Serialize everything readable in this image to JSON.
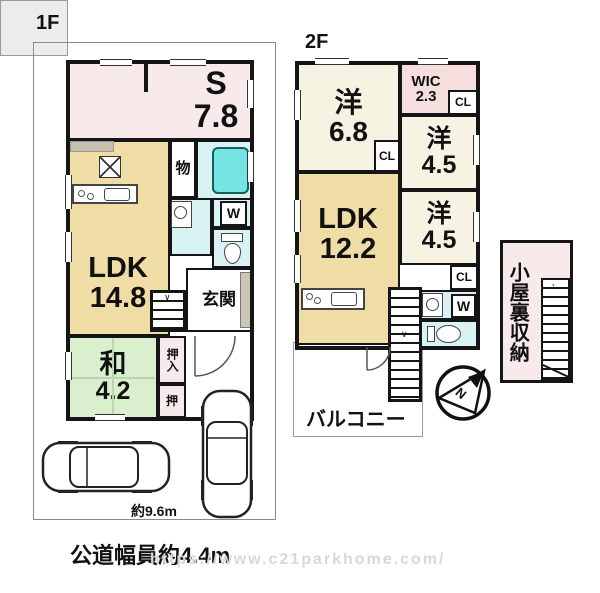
{
  "floor1": {
    "label": "1F",
    "s_name": "S",
    "s_size": "7.8",
    "ldk_name": "LDK",
    "ldk_size": "14.8",
    "wa_name": "和",
    "wa_size": "4.2",
    "storage": "物",
    "washer": "W",
    "entrance": "玄関",
    "oshiire": "押入",
    "oshi": "押",
    "dimension": "約9.6m"
  },
  "floor2": {
    "label": "2F",
    "west1_name": "洋",
    "west1_size": "6.8",
    "wic_name": "WIC",
    "wic_size": "2.3",
    "west2_name": "洋",
    "west2_size": "4.5",
    "west3_name": "洋",
    "west3_size": "4.5",
    "ldk_name": "LDK",
    "ldk_size": "12.2",
    "cl1": "CL",
    "cl2": "CL",
    "cl3": "CL",
    "washer": "W",
    "balcony": "バルコニー",
    "attic": "小屋裏収納",
    "compass_letter": "N"
  },
  "footer": {
    "road_label": "公道幅員約4.4m",
    "watermark": "https://www.c21parkhome.com/"
  },
  "icons": {
    "stair_down_arrow": "∨",
    "stair_up_arrow": "↑"
  },
  "colors": {
    "wall": "#151515",
    "room_pink": "#f8e9ea",
    "room_pink_strong": "#f6dede",
    "room_tan": "#f0dca5",
    "room_cream": "#f7f3e3",
    "room_green": "#d9efcd",
    "room_cyan": "#d9f3f4",
    "bathtub": "#76e3e3",
    "porch_gray": "#ececec",
    "watermark_gray": "#d8d8d8"
  }
}
